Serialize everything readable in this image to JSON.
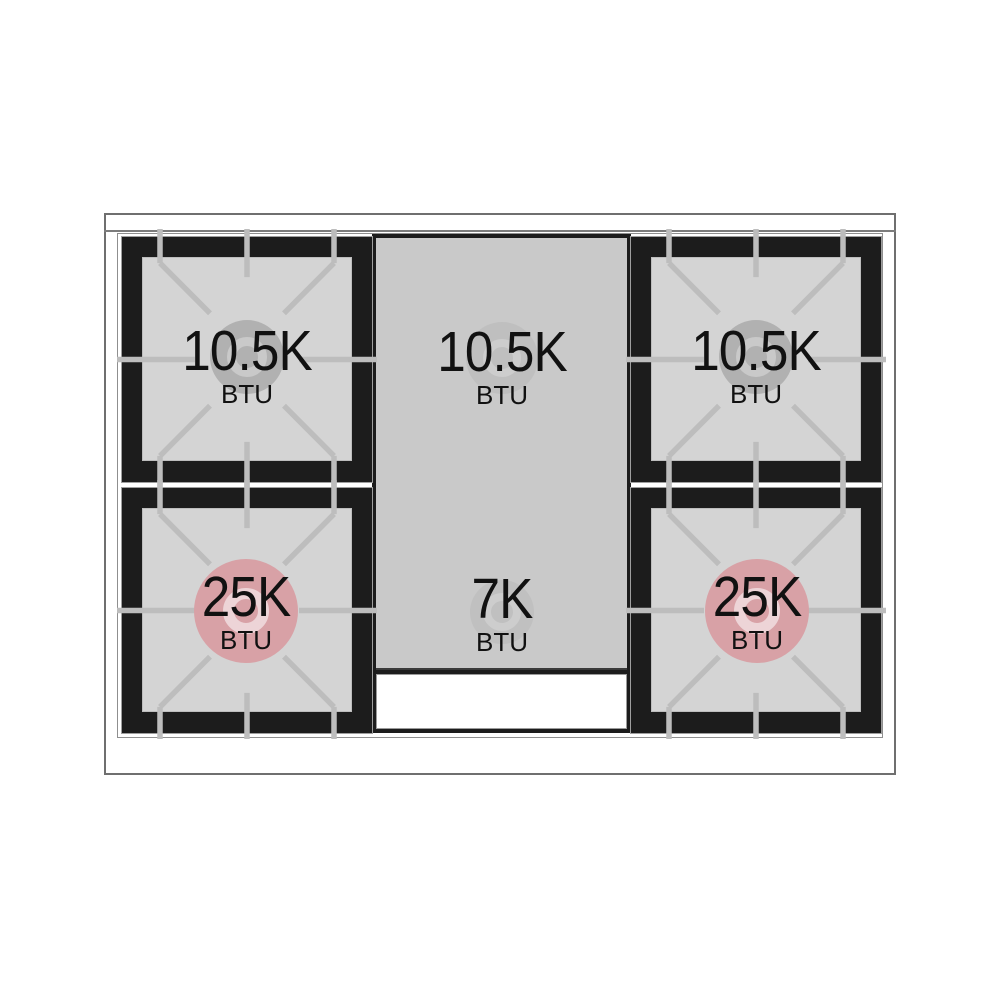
{
  "diagram_type": "gas-range-cooktop-burner-btu-layout",
  "burners": [
    {
      "position": "top-left",
      "power": "10.5K",
      "unit": "BTU"
    },
    {
      "position": "top-center",
      "power": "10.5K",
      "unit": "BTU"
    },
    {
      "position": "top-right",
      "power": "10.5K",
      "unit": "BTU"
    },
    {
      "position": "bottom-left",
      "power": "25K",
      "unit": "BTU"
    },
    {
      "position": "bottom-center",
      "power": "7K",
      "unit": "BTU"
    },
    {
      "position": "bottom-right",
      "power": "25K",
      "unit": "BTU"
    }
  ],
  "colors": {
    "plate_black": "#1c1c1c",
    "grate_line": "#bdbdbd",
    "burner_square_gray": "#d4d4d4",
    "griddle_panel_gray": "#c9c9c9",
    "burner_cap_gray": "#b1b1b1",
    "burner_cap_pink": "#d8a1a6",
    "cap_ring_gray": "#c9c9c9",
    "cap_ring_pink": "#edd4d7",
    "frame_line_gray": "#6f6f6f",
    "label_text": "#111111"
  }
}
